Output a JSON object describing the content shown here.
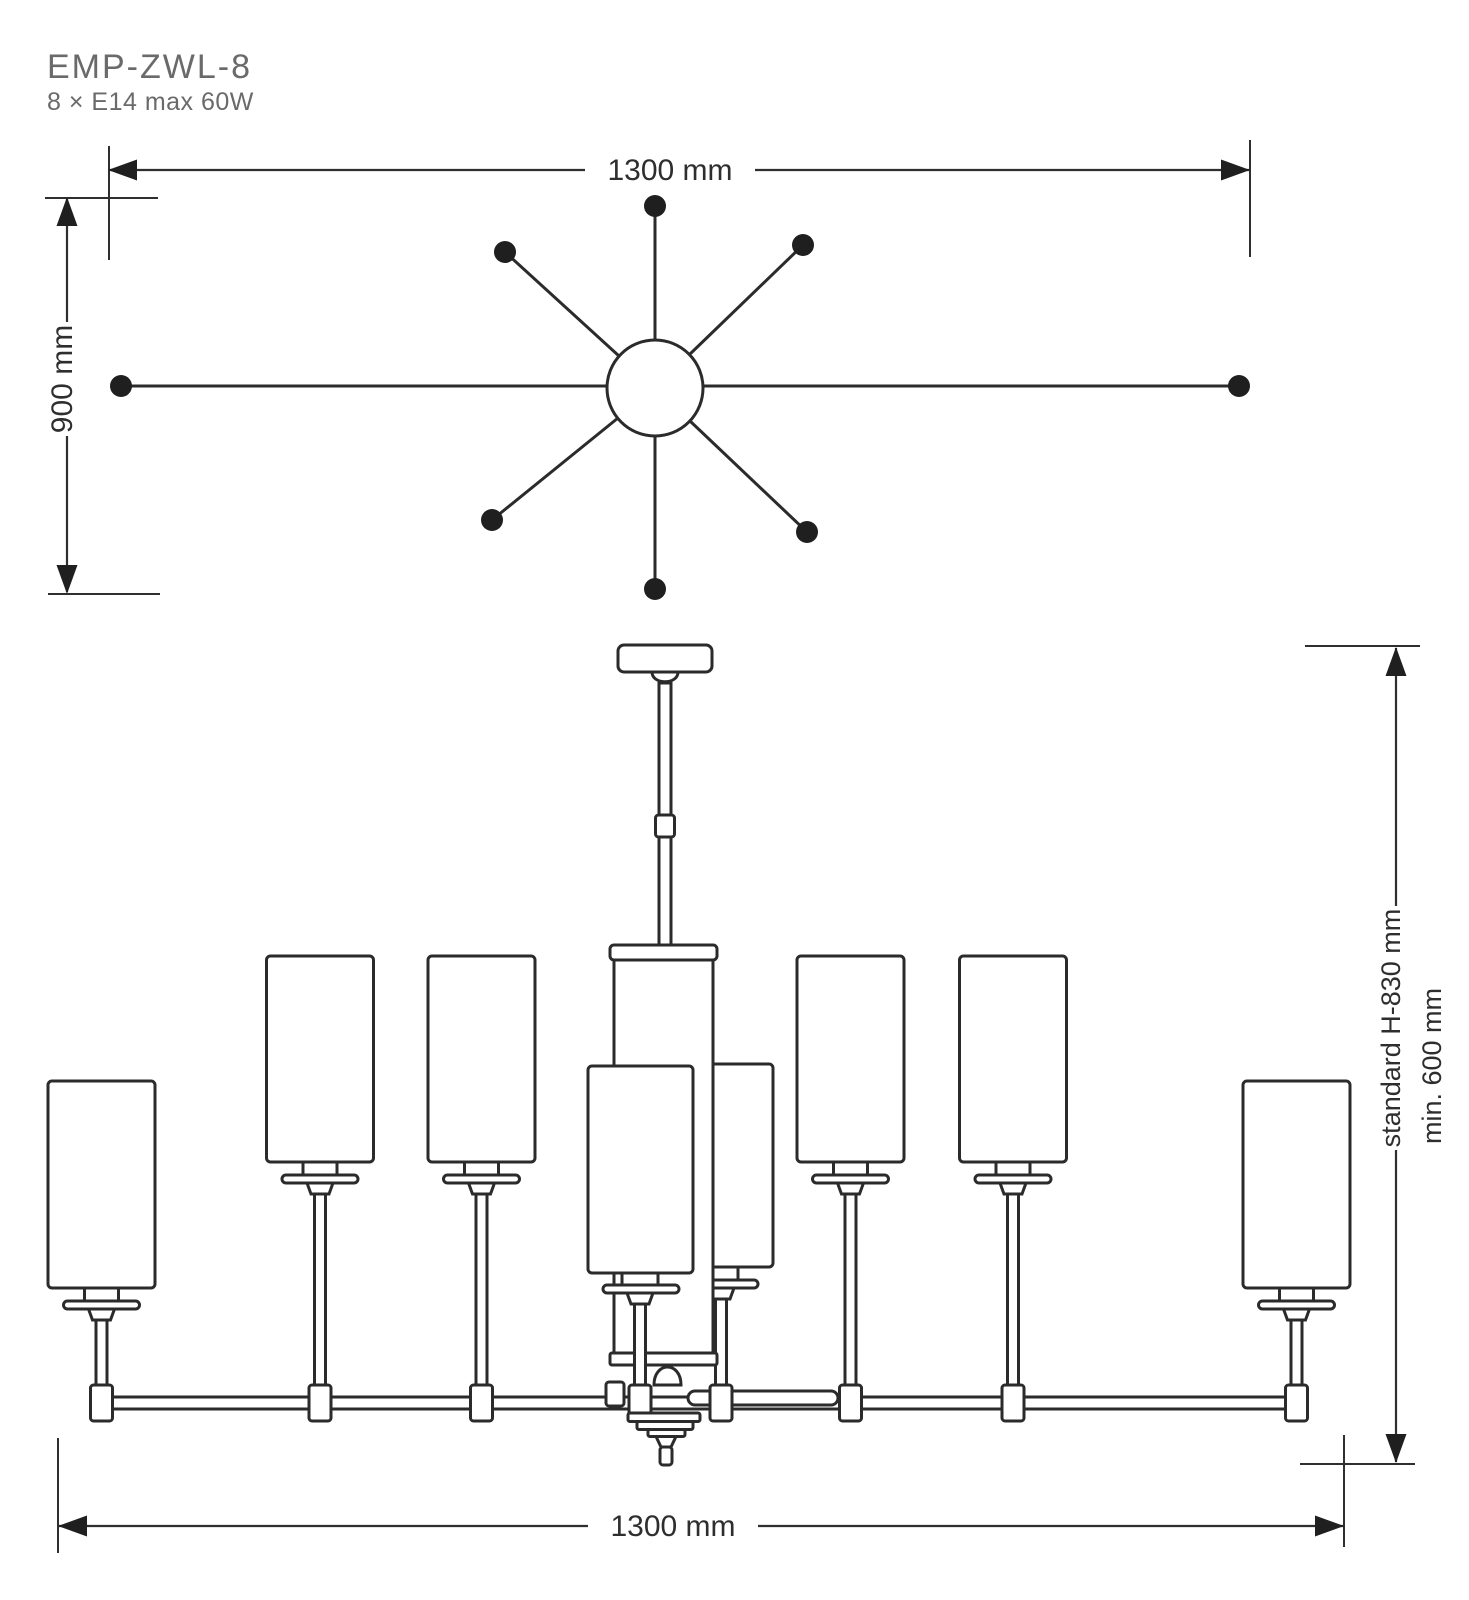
{
  "header": {
    "product_code": "EMP-ZWL-8",
    "lamp_spec": "8 × E14 max 60W"
  },
  "dimensions": {
    "plan_width": "1300 mm",
    "plan_depth": "900 mm",
    "elevation_width": "1300 mm",
    "height_standard": "standard H-830 mm",
    "height_min": "min. 600 mm"
  },
  "drawing": {
    "type": "technical dimension diagram",
    "views": {
      "plan": "8-arm star top view",
      "elevation": "chandelier front view"
    },
    "arm_count": 8
  },
  "colors": {
    "line": "#2b2b2b",
    "dimension_line": "#2f2f2f",
    "muted_text": "#6a6a6a",
    "dimension_text": "#2e2e2e",
    "background": "#ffffff"
  }
}
